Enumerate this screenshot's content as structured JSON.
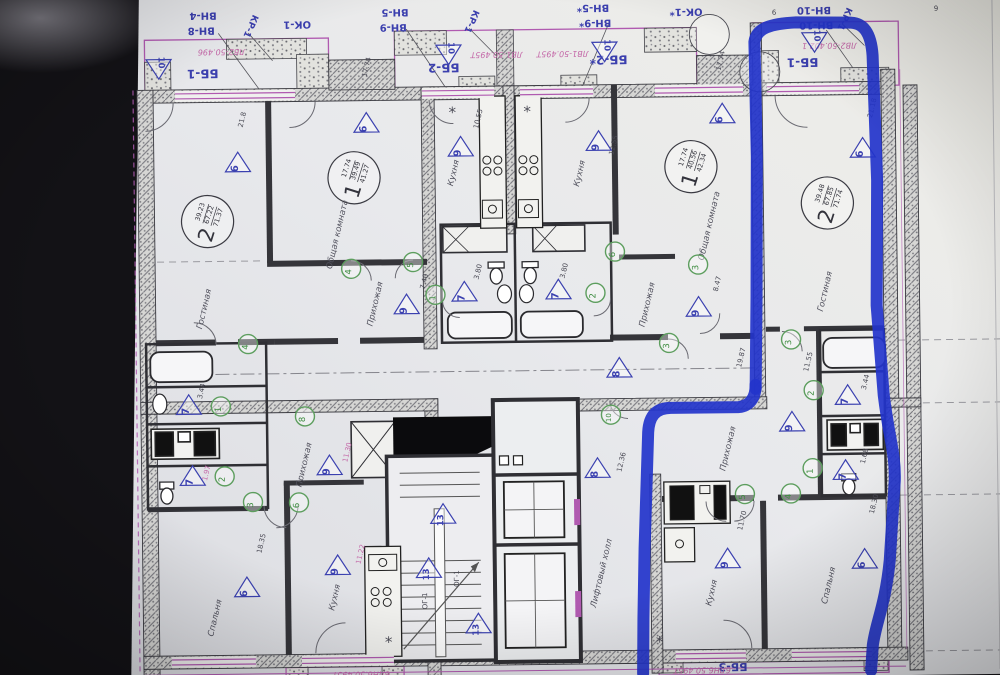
{
  "title": "floor-plan-photo",
  "colors": {
    "paper": "#e8e9ec",
    "accent_magenta": "#b05ab0",
    "tag_blue": "#3b3fae",
    "marker_green": "#5d9e5e",
    "highlighter_blue": "#2334cb",
    "pink_stamp": "#c468a8"
  },
  "window_tags": [
    {
      "t": "ВН-4",
      "x": 207,
      "y": 9,
      "s": 10
    },
    {
      "t": "ВН-8",
      "x": 205,
      "y": 24,
      "s": 10
    },
    {
      "t": "КР-1",
      "x": 252,
      "y": 22,
      "s": 9,
      "rot": 115
    },
    {
      "t": "ОК-1",
      "x": 301,
      "y": 19,
      "s": 10
    },
    {
      "t": "ВН-5",
      "x": 399,
      "y": 8,
      "s": 10
    },
    {
      "t": "ВН-9",
      "x": 397,
      "y": 23,
      "s": 10
    },
    {
      "t": "КР-1",
      "x": 473,
      "y": 20,
      "s": 9,
      "rot": 115
    },
    {
      "t": "ВН-5*",
      "x": 597,
      "y": 6,
      "s": 10
    },
    {
      "t": "ВН-9*",
      "x": 599,
      "y": 21,
      "s": 10
    },
    {
      "t": "ОК-1*",
      "x": 690,
      "y": 11,
      "s": 10
    },
    {
      "t": "ВН-10",
      "x": 818,
      "y": 11,
      "s": 10
    },
    {
      "t": "ВН-10",
      "x": 820,
      "y": 26,
      "s": 10
    },
    {
      "t": "КР-1",
      "x": 846,
      "y": 22,
      "s": 9,
      "rot": 115
    },
    {
      "t": "ББ-1",
      "x": 206,
      "y": 66,
      "s": 12
    },
    {
      "t": "ББ-2",
      "x": 447,
      "y": 63,
      "s": 12
    },
    {
      "t": "ББ-2*",
      "x": 612,
      "y": 57,
      "s": 12
    },
    {
      "t": "ББ-1",
      "x": 806,
      "y": 62,
      "s": 12
    },
    {
      "t": "ББ-3",
      "x": 729,
      "y": 666,
      "s": 11
    }
  ],
  "pink_stamps": [
    {
      "t": "ЛВ2-50.496",
      "x": 225,
      "y": 46
    },
    {
      "t": "ЛВ1-50.495Т",
      "x": 500,
      "y": 52
    },
    {
      "t": "ЛВ1-50.495Т",
      "x": 566,
      "y": 52
    },
    {
      "t": "ЛВ2-50.402.1",
      "x": 833,
      "y": 47
    },
    {
      "t": "6ЛН6.50.495Т",
      "x": 357,
      "y": 670
    },
    {
      "t": "6ЛН6.50.495Т",
      "x": 698,
      "y": 670
    }
  ],
  "rooms": [
    {
      "t": "Гостиная",
      "x": 207,
      "y": 306
    },
    {
      "t": "Общая комната",
      "x": 341,
      "y": 233
    },
    {
      "t": "Кухня",
      "x": 458,
      "y": 173
    },
    {
      "t": "Кухня",
      "x": 584,
      "y": 175
    },
    {
      "t": "Общая комната",
      "x": 713,
      "y": 229
    },
    {
      "t": "Гостиная",
      "x": 828,
      "y": 296
    },
    {
      "t": "Прихожая",
      "x": 378,
      "y": 303
    },
    {
      "t": "Прихожая",
      "x": 650,
      "y": 307
    },
    {
      "t": "Прихожая",
      "x": 305,
      "y": 463
    },
    {
      "t": "Прихожая",
      "x": 729,
      "y": 452
    },
    {
      "t": "Кухня",
      "x": 711,
      "y": 596
    },
    {
      "t": "Спальня",
      "x": 828,
      "y": 590
    },
    {
      "t": "Спальня",
      "x": 214,
      "y": 615
    },
    {
      "t": "Кухня",
      "x": 334,
      "y": 596
    },
    {
      "t": "Лифтовый холл",
      "x": 601,
      "y": 575
    }
  ],
  "apartments": [
    {
      "num": "2",
      "areas": [
        "39.23",
        "67.22",
        "71.37"
      ],
      "x": 209,
      "y": 218
    },
    {
      "num": "1",
      "areas": [
        "17.74",
        "39.49",
        "41.27"
      ],
      "x": 356,
      "y": 176
    },
    {
      "num": "1",
      "areas": [
        "17.74",
        "40.56",
        "42.34"
      ],
      "x": 693,
      "y": 169
    },
    {
      "num": "2",
      "areas": [
        "39.48",
        "67.85",
        "71.74"
      ],
      "x": 829,
      "y": 207
    }
  ],
  "triangles": [
    {
      "n": "6",
      "x": 240,
      "y": 160
    },
    {
      "n": "6",
      "x": 369,
      "y": 122
    },
    {
      "n": "9",
      "x": 463,
      "y": 147
    },
    {
      "n": "9",
      "x": 601,
      "y": 143
    },
    {
      "n": "6",
      "x": 725,
      "y": 117
    },
    {
      "n": "6",
      "x": 865,
      "y": 153
    },
    {
      "n": "9",
      "x": 407,
      "y": 304
    },
    {
      "n": "7",
      "x": 465,
      "y": 292
    },
    {
      "n": "7",
      "x": 559,
      "y": 291
    },
    {
      "n": "9",
      "x": 699,
      "y": 310
    },
    {
      "n": "8",
      "x": 619,
      "y": 370
    },
    {
      "n": "8",
      "x": 596,
      "y": 470
    },
    {
      "n": "13",
      "x": 441,
      "y": 514
    },
    {
      "n": "13",
      "x": 426,
      "y": 568
    },
    {
      "n": "13",
      "x": 475,
      "y": 624
    },
    {
      "n": "7",
      "x": 188,
      "y": 402
    },
    {
      "n": "7",
      "x": 191,
      "y": 473
    },
    {
      "n": "9",
      "x": 328,
      "y": 464
    },
    {
      "n": "9",
      "x": 791,
      "y": 426
    },
    {
      "n": "7",
      "x": 847,
      "y": 400
    },
    {
      "n": "7",
      "x": 844,
      "y": 475
    },
    {
      "n": "9",
      "x": 725,
      "y": 562
    },
    {
      "n": "6",
      "x": 862,
      "y": 564
    },
    {
      "n": "6",
      "x": 244,
      "y": 585
    },
    {
      "n": "9",
      "x": 335,
      "y": 564
    },
    {
      "n": "10",
      "x": 162,
      "y": 64,
      "rot": 180
    },
    {
      "n": "10",
      "x": 452,
      "y": 53,
      "rot": 180
    },
    {
      "n": "10",
      "x": 608,
      "y": 52,
      "rot": 180
    },
    {
      "n": "10",
      "x": 818,
      "y": 45,
      "rot": 180
    }
  ],
  "greens": [
    {
      "n": "4",
      "x": 248,
      "y": 341
    },
    {
      "n": "1",
      "x": 220,
      "y": 403
    },
    {
      "n": "2",
      "x": 223,
      "y": 473
    },
    {
      "n": "3",
      "x": 251,
      "y": 499
    },
    {
      "n": "6",
      "x": 297,
      "y": 500
    },
    {
      "n": "8",
      "x": 304,
      "y": 414
    },
    {
      "n": "4",
      "x": 352,
      "y": 267
    },
    {
      "n": "5",
      "x": 414,
      "y": 261
    },
    {
      "n": "1",
      "x": 436,
      "y": 294
    },
    {
      "n": "2",
      "x": 596,
      "y": 294
    },
    {
      "n": "6",
      "x": 616,
      "y": 253
    },
    {
      "n": "3",
      "x": 669,
      "y": 345
    },
    {
      "n": "10",
      "x": 610,
      "y": 416
    },
    {
      "n": "3",
      "x": 699,
      "y": 267
    },
    {
      "n": "3",
      "x": 791,
      "y": 343
    },
    {
      "n": "2",
      "x": 813,
      "y": 394
    },
    {
      "n": "1",
      "x": 811,
      "y": 472
    },
    {
      "n": "4",
      "x": 789,
      "y": 497
    },
    {
      "n": "5",
      "x": 743,
      "y": 497
    }
  ],
  "dims": [
    {
      "t": "21.8",
      "x": 247,
      "y": 117
    },
    {
      "t": "10.55",
      "x": 483,
      "y": 119
    },
    {
      "t": "12.55",
      "x": 618,
      "y": 147
    },
    {
      "t": "17.74",
      "x": 372,
      "y": 66
    },
    {
      "t": "17.74",
      "x": 726,
      "y": 64
    },
    {
      "t": "21.18",
      "x": 877,
      "y": 113
    },
    {
      "t": "7.40",
      "x": 427,
      "y": 281
    },
    {
      "t": "3.80",
      "x": 481,
      "y": 272
    },
    {
      "t": "3.80",
      "x": 567,
      "y": 272
    },
    {
      "t": "8.47",
      "x": 720,
      "y": 287
    },
    {
      "t": "3.44",
      "x": 203,
      "y": 388
    },
    {
      "t": "1.97",
      "x": 207,
      "y": 470,
      "pink": true
    },
    {
      "t": "11.30",
      "x": 348,
      "y": 451,
      "pink": true
    },
    {
      "t": "19.87",
      "x": 743,
      "y": 361
    },
    {
      "t": "12.36",
      "x": 622,
      "y": 464
    },
    {
      "t": "11.55",
      "x": 810,
      "y": 366
    },
    {
      "t": "3.44",
      "x": 867,
      "y": 387
    },
    {
      "t": "1.68",
      "x": 865,
      "y": 461
    },
    {
      "t": "11.70",
      "x": 742,
      "y": 524
    },
    {
      "t": "18.30",
      "x": 874,
      "y": 509
    },
    {
      "t": "18.35",
      "x": 261,
      "y": 541
    },
    {
      "t": "11.22",
      "x": 360,
      "y": 553,
      "pink": true
    },
    {
      "t": "9",
      "x": 778,
      "y": 13,
      "r": 180
    },
    {
      "t": "6",
      "x": 940,
      "y": 11,
      "r": 180
    }
  ],
  "stair_labels": [
    {
      "t": "ОГ-1",
      "x": 424,
      "y": 600
    },
    {
      "t": "ОГ-1",
      "x": 456,
      "y": 578
    }
  ],
  "star_symbol": "*",
  "stars": [
    [
      455,
      112
    ],
    [
      530,
      112
    ],
    [
      385,
      641
    ],
    [
      656,
      644
    ]
  ],
  "axis_circles": [
    [
      713,
      37,
      20
    ],
    [
      763,
      75,
      20
    ]
  ],
  "highlight": {
    "color": "#2334cb",
    "width": 12,
    "paths": [
      "M755,392 L757,300 L759,160 L758,45 C760,31 775,27 800,26 L855,27 C870,28 875,42 876,60 L879,185 L877,310 L883,400 C888,445 894,458 893,485 L887,565 C882,610 872,628 869,650 L867,675",
      "M755,388 C755,402 748,409 738,410 L670,410 C654,410 648,419 647,434 L642,550 L640,620 L639,675"
    ]
  }
}
